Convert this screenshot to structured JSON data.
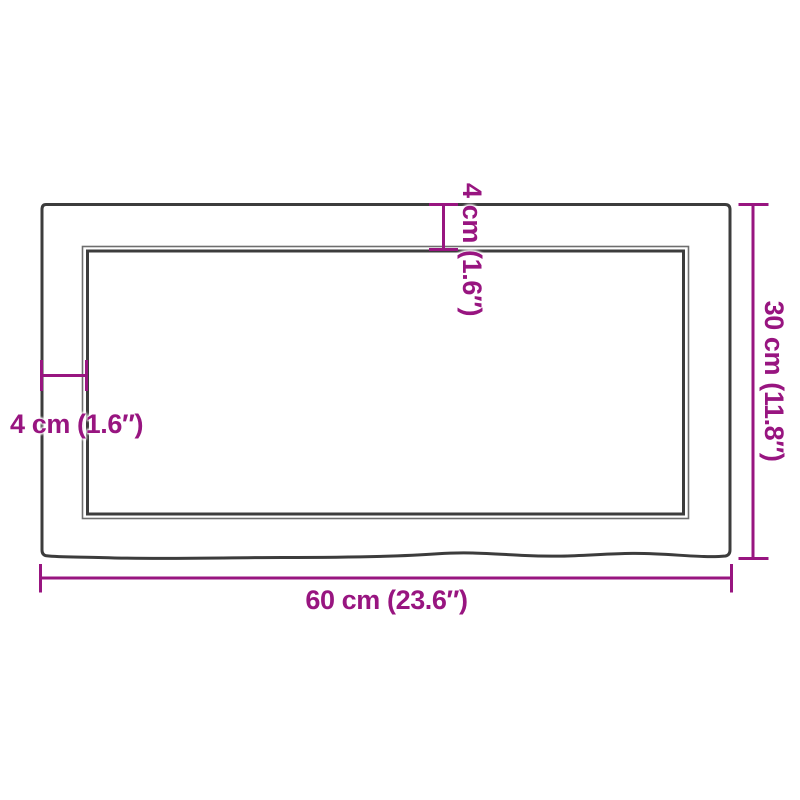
{
  "diagram": {
    "type": "product-dimension-diagram",
    "dimensions": {
      "width_label": "60 cm (23.6″)",
      "height_label": "30 cm (11.8″)",
      "top_thickness_label": "4 cm (1.6″)",
      "left_thickness_label": "4 cm (1.6″)"
    }
  },
  "colors": {
    "dimension": "#981580",
    "outline": "#3c3c3c",
    "outline-thin": "#6e6e6e",
    "background": "#ffffff"
  }
}
